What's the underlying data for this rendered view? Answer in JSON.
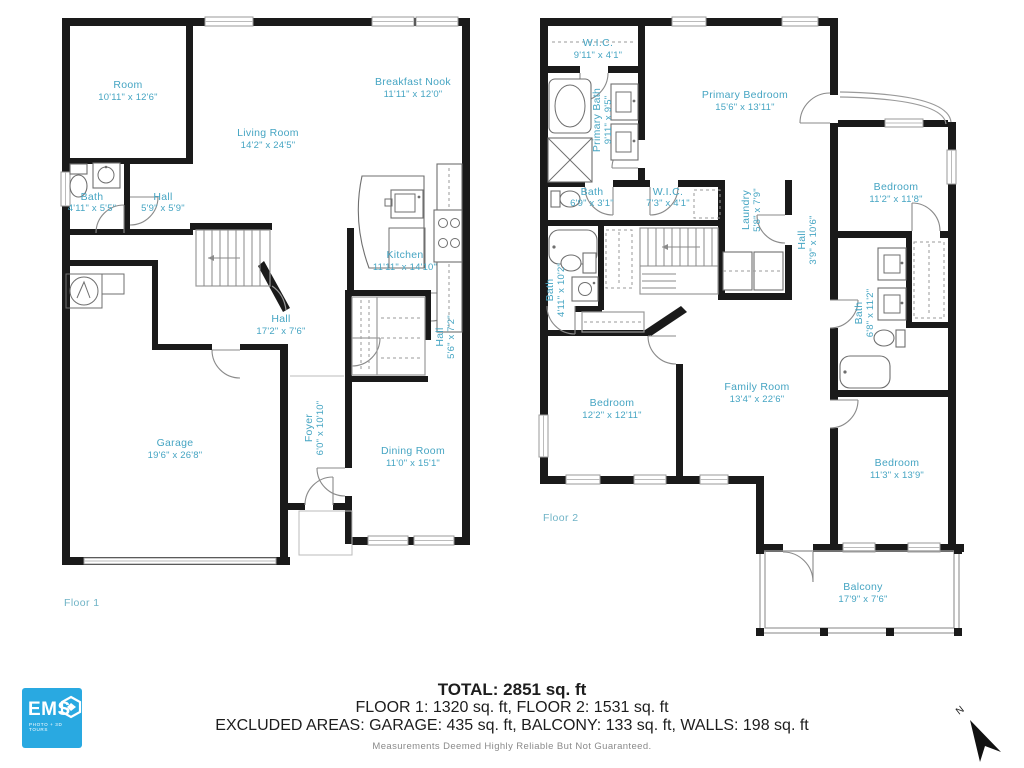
{
  "colors": {
    "wall": "#1a1a1a",
    "room_label": "#46a5c3",
    "logo_blue": "#29a9e1"
  },
  "floor1": {
    "label": "Floor 1",
    "rooms": {
      "room": {
        "name": "Room",
        "dims": "10'11\" x 12'6\""
      },
      "living": {
        "name": "Living Room",
        "dims": "14'2\" x 24'5\""
      },
      "breakfast": {
        "name": "Breakfast Nook",
        "dims": "11'11\" x 12'0\""
      },
      "bath": {
        "name": "Bath",
        "dims": "4'11\" x 5'5\""
      },
      "hall_small": {
        "name": "Hall",
        "dims": "5'9\" x 5'9\""
      },
      "kitchen": {
        "name": "Kitchen",
        "dims": "11'11\" x 14'10\""
      },
      "hall_long": {
        "name": "Hall",
        "dims": "17'2\" x 7'6\""
      },
      "hall_side": {
        "name": "Hall",
        "dims": "5'6\" x 7'2\""
      },
      "foyer": {
        "name": "Foyer",
        "dims": "6'0\" x 10'10\""
      },
      "garage": {
        "name": "Garage",
        "dims": "19'6\" x 26'8\""
      },
      "dining": {
        "name": "Dining Room",
        "dims": "11'0\" x 15'1\""
      }
    }
  },
  "floor2": {
    "label": "Floor 2",
    "rooms": {
      "wic1": {
        "name": "W.I.C.",
        "dims": "9'11\" x 4'1\""
      },
      "primary_bath": {
        "name": "Primary Bath",
        "dims": "9'11\" x 9'5\""
      },
      "primary_bedroom": {
        "name": "Primary Bedroom",
        "dims": "15'6\" x 13'11\""
      },
      "bath_small": {
        "name": "Bath",
        "dims": "6'9\" x 3'1\""
      },
      "wic2": {
        "name": "W.I.C.",
        "dims": "7'3\" x 4'1\""
      },
      "laundry": {
        "name": "Laundry",
        "dims": "5'8\" x 7'9\""
      },
      "hall": {
        "name": "Hall",
        "dims": "3'9\" x 10'6\""
      },
      "bedroom_tr": {
        "name": "Bedroom",
        "dims": "11'2\" x 11'8\""
      },
      "bath_left": {
        "name": "Bath",
        "dims": "4'11\" x 10'2\""
      },
      "bath_right": {
        "name": "Bath",
        "dims": "6'8\" x 11'2\""
      },
      "bedroom_left": {
        "name": "Bedroom",
        "dims": "12'2\" x 12'11\""
      },
      "family": {
        "name": "Family Room",
        "dims": "13'4\" x 22'6\""
      },
      "bedroom_br": {
        "name": "Bedroom",
        "dims": "11'3\" x 13'9\""
      },
      "balcony": {
        "name": "Balcony",
        "dims": "17'9\" x 7'6\""
      }
    }
  },
  "summary": {
    "total": "TOTAL: 2851 sq. ft",
    "floors": "FLOOR 1: 1320 sq. ft, FLOOR 2: 1531 sq. ft",
    "excluded": "EXCLUDED AREAS: GARAGE: 435 sq. ft, BALCONY: 133 sq. ft, WALLS: 198 sq. ft",
    "disclaimer": "Measurements Deemed Highly Reliable But Not Guaranteed."
  },
  "logo": {
    "brand": "EMS",
    "tagline": "PHOTO + 3D TOURS"
  },
  "compass": {
    "label": "N"
  }
}
